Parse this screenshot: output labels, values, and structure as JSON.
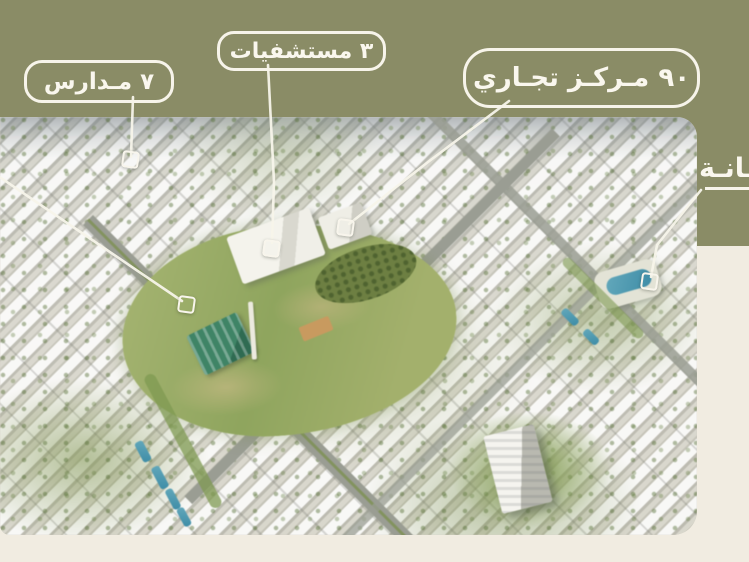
{
  "slide": {
    "background_color": "#f1ece1",
    "band_color": "#8a8c66",
    "callout_text_color": "#faf7ee"
  },
  "callouts": {
    "schools": {
      "label": "٧ مـدارس"
    },
    "hospitals": {
      "label": "٣ مستشفيات"
    },
    "commercial": {
      "label": "٩٠ مـركـز تجـاري"
    },
    "clipped_right": {
      "label": "ـانـة"
    }
  },
  "map": {
    "kind": "aerial-masterplan-render",
    "markers": [
      "schools",
      "hospitals",
      "commercial",
      "mosque",
      "pool"
    ]
  }
}
